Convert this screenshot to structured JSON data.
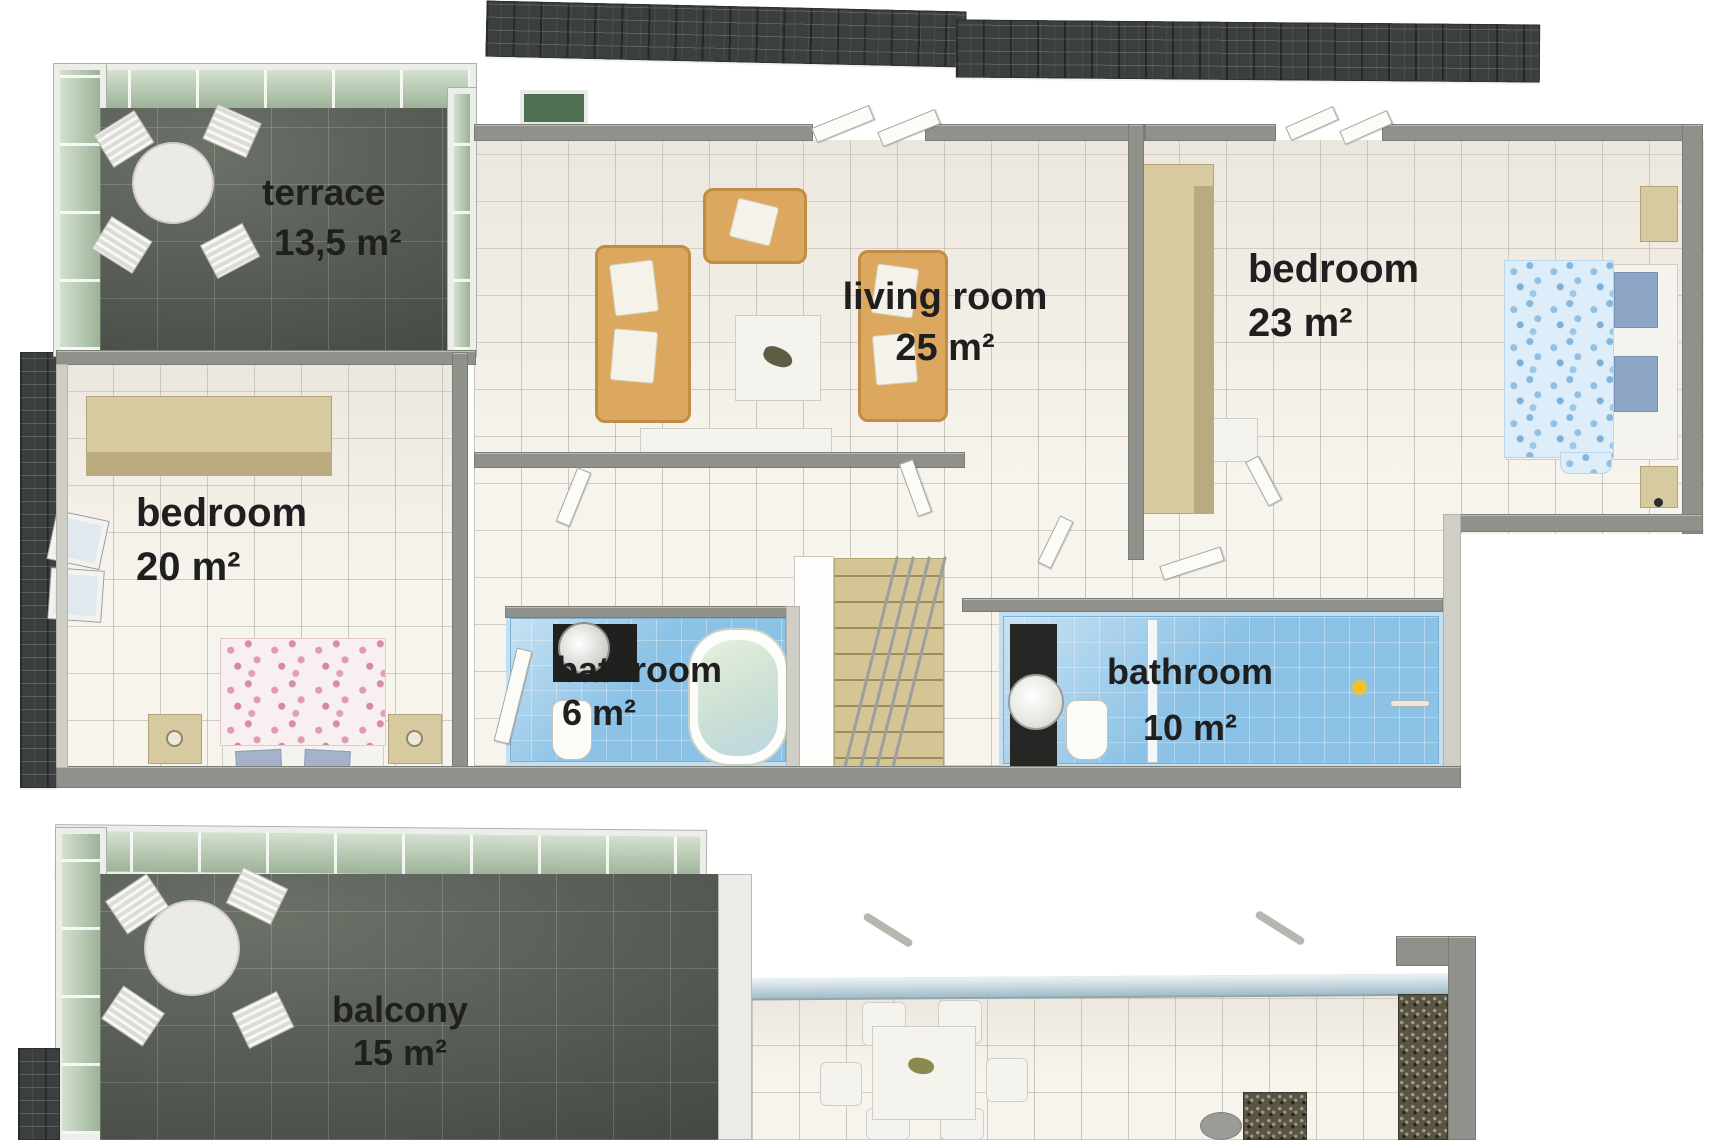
{
  "rooms": {
    "terrace": {
      "name": "terrace",
      "area": "13,5 m²"
    },
    "living_room": {
      "name": "living room",
      "area": "25 m²"
    },
    "bedroom_right": {
      "name": "bedroom",
      "area": "23 m²"
    },
    "bedroom_left": {
      "name": "bedroom",
      "area": "20 m²"
    },
    "bathroom_small": {
      "name": "bathroom",
      "area": "6 m²"
    },
    "bathroom_large": {
      "name": "bathroom",
      "area": "10 m²"
    },
    "balcony": {
      "name": "balcony",
      "area": "15 m²"
    }
  },
  "palette": {
    "roof": "#3b3f3f",
    "terrace_tile": "#5d625b",
    "interior_tile": "#f7f4ed",
    "bathroom_tile": "#8cc2e6",
    "glass": "#b8ccb1",
    "wall": "#90918a",
    "wood": "#d7caa0",
    "sofa": "#dca75f",
    "label_text": "#1f1f1f"
  }
}
